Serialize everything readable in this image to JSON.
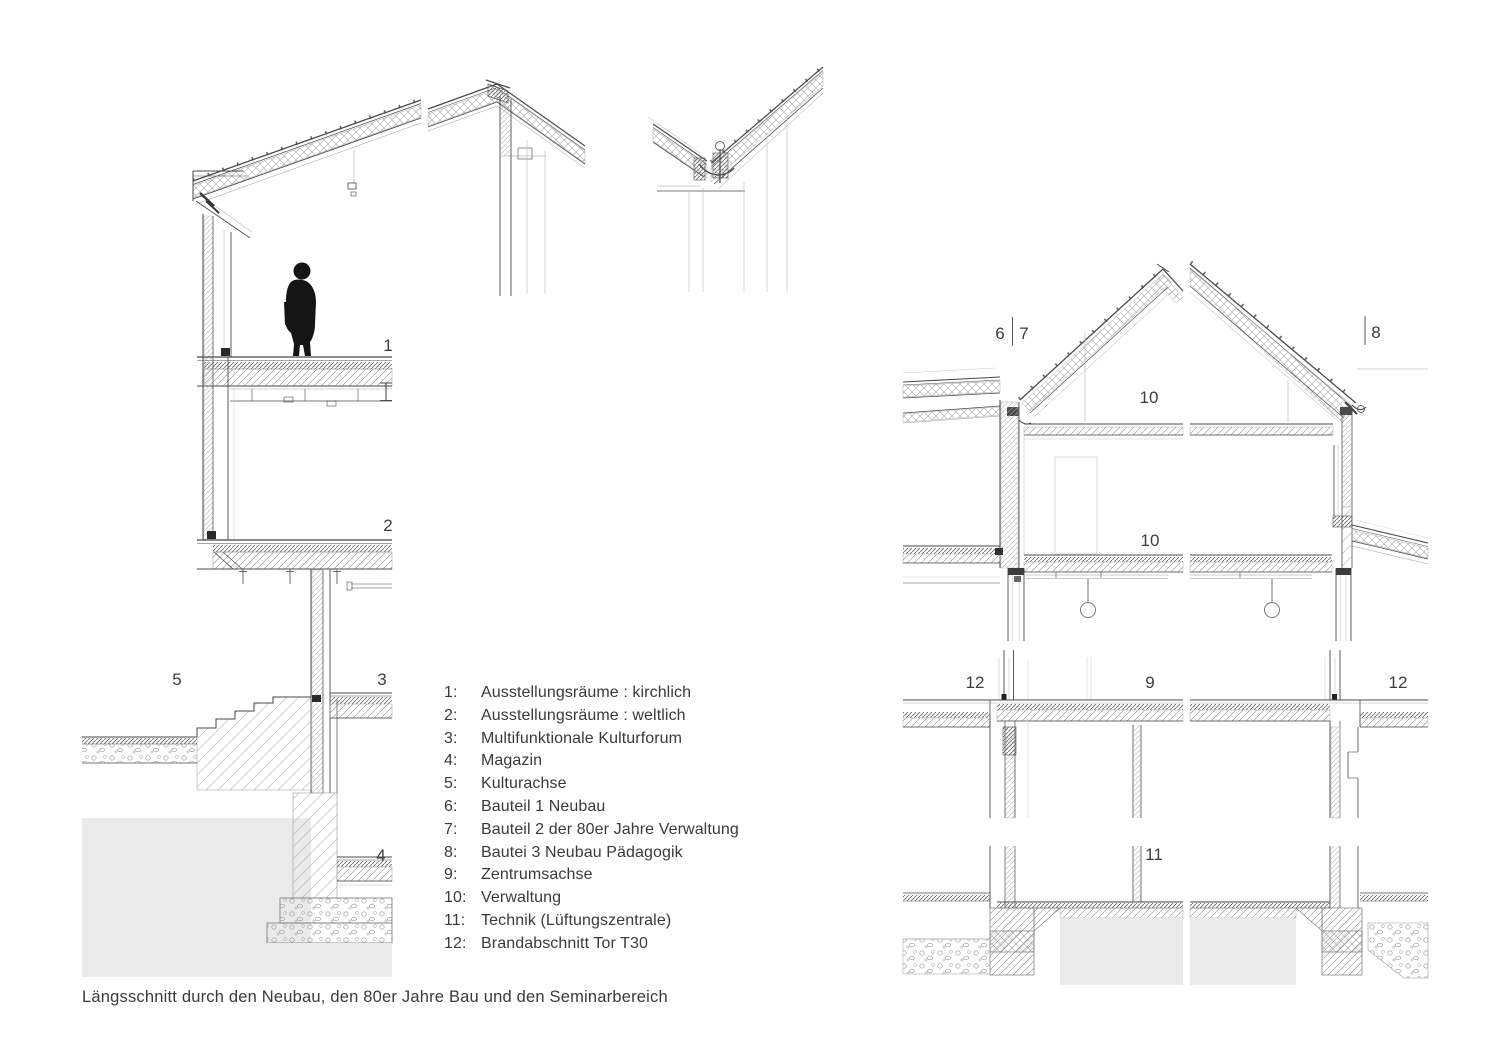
{
  "figure": {
    "caption": "Längsschnitt durch den Neubau, den 80er Jahre Bau und den Seminarbereich"
  },
  "legend": {
    "items": [
      {
        "num": "1:",
        "label": "Ausstellungsräume : kirchlich"
      },
      {
        "num": "2:",
        "label": "Ausstellungsräume : weltlich"
      },
      {
        "num": "3:",
        "label": "Multifunktionale Kulturforum"
      },
      {
        "num": "4:",
        "label": "Magazin"
      },
      {
        "num": "5:",
        "label": "Kulturachse"
      },
      {
        "num": "6:",
        "label": "Bauteil 1 Neubau"
      },
      {
        "num": "7:",
        "label": "Bauteil 2 der 80er Jahre Verwaltung"
      },
      {
        "num": "8:",
        "label": "Bautei 3 Neubau Pädagogik"
      },
      {
        "num": "9:",
        "label": "Zentrumsachse"
      },
      {
        "num": "10:",
        "label": "Verwaltung"
      },
      {
        "num": "11:",
        "label": "Technik (Lüftungszentrale)"
      },
      {
        "num": "12:",
        "label": "Brandabschnitt Tor T30"
      }
    ]
  },
  "markers": {
    "m1": "1",
    "m2": "2",
    "m3": "3",
    "m4": "4",
    "m5": "5",
    "m6": "6",
    "m7": "7",
    "m8": "8",
    "m10_attic": "10",
    "m10_room": "10",
    "m12_left": "12",
    "m9": "9",
    "m12_right": "12",
    "m11": "11"
  },
  "colors": {
    "line": "#4a4a4a",
    "faint_line": "#b5b5b5",
    "ground_fill": "#eaeaea",
    "text": "#3a3a3a",
    "silhouette": "#151515"
  }
}
